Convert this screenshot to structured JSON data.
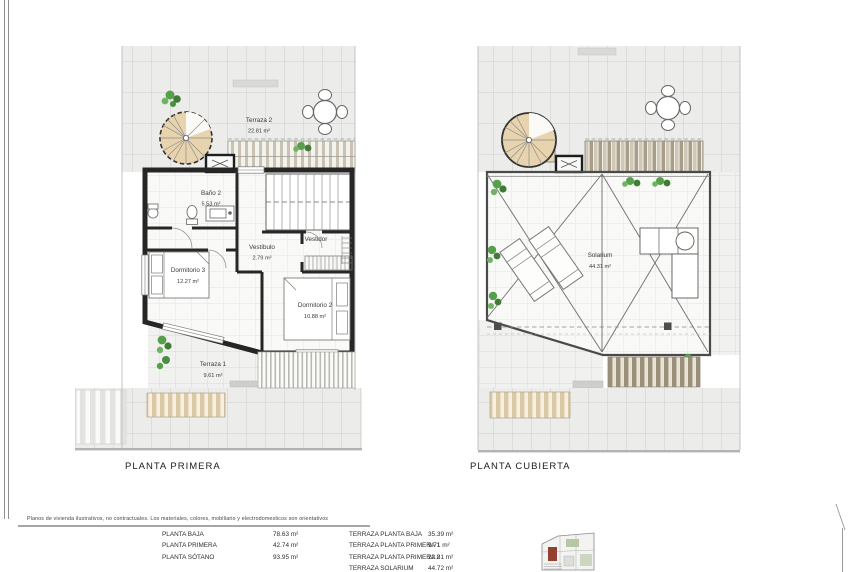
{
  "page": {
    "disclaimer": "Planos de vivienda ilustrativos, no contractuales. Los materiales, colores, mobiliario y electrodomesticos son orientativos"
  },
  "plans": {
    "left": {
      "title": "PLANTA PRIMERA",
      "rooms": {
        "terraza2": {
          "name": "Terraza 2",
          "area": "22.81 m²"
        },
        "bano2": {
          "name": "Baño 2",
          "area": "5.53 m²"
        },
        "vestibulo": {
          "name": "Vestíbulo",
          "area": "2.79 m²"
        },
        "vestidor": {
          "name": "Vestidor"
        },
        "dormitorio3": {
          "name": "Dormitorio 3",
          "area": "12.27 m²"
        },
        "dormitorio2": {
          "name": "Dormitorio 2",
          "area": "10.88 m²"
        },
        "terraza1": {
          "name": "Terraza 1",
          "area": "9.61 m²"
        }
      }
    },
    "right": {
      "title": "PLANTA CUBIERTA",
      "rooms": {
        "solarium": {
          "name": "Solarium",
          "area": "44.31 m²"
        }
      }
    }
  },
  "areas_table": {
    "left_column": [
      {
        "label": "PLANTA BAJA",
        "value": "78.63 m²"
      },
      {
        "label": "PLANTA PRIMERA",
        "value": "42.74 m²"
      },
      {
        "label": "PLANTA SÓTANO",
        "value": "93.95 m²"
      }
    ],
    "right_column": [
      {
        "label": "TERRAZA PLANTA BAJA",
        "value": "35.39 m²"
      },
      {
        "label": "TERRAZA PLANTA PRIMERA 1",
        "value": "9.71 m²"
      },
      {
        "label": "TERRAZA PLANTA PRIMERA 2",
        "value": "22.81 m²"
      },
      {
        "label": "TERRAZA SOLARIUM",
        "value": "44.72 m²"
      }
    ]
  },
  "colors": {
    "wall": "#262626",
    "tan": "#e7d3ae",
    "plant": "#55a04a",
    "tile": "#ececeb"
  }
}
